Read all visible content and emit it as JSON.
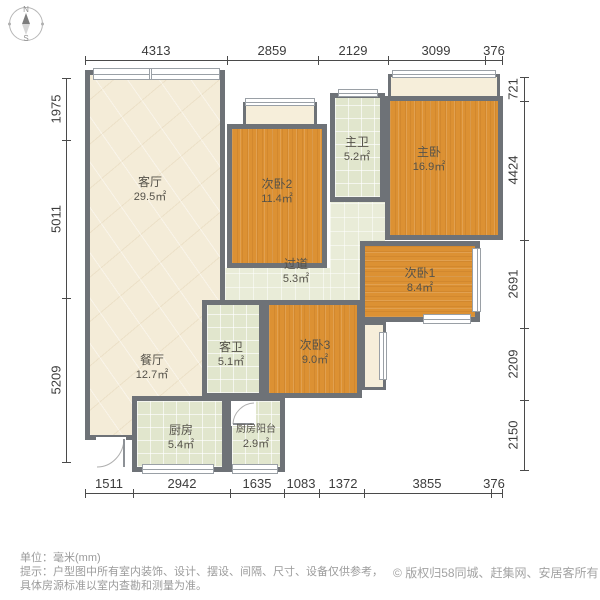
{
  "compass": {
    "north": "N",
    "south": "S"
  },
  "dimensions": {
    "unit_note": "mm",
    "top": [
      "4313",
      "2859",
      "2129",
      "3099",
      "376"
    ],
    "bottom": [
      "1511",
      "2942",
      "1635",
      "1083",
      "1372",
      "3855",
      "376"
    ],
    "left": [
      "1975",
      "5011",
      "5209"
    ],
    "right": [
      "721",
      "4424",
      "2691",
      "2209",
      "2150"
    ]
  },
  "rooms": [
    {
      "name": "living-room",
      "label": "客厅",
      "area": "29.5㎡"
    },
    {
      "name": "dining-room",
      "label": "餐厅",
      "area": "12.7㎡"
    },
    {
      "name": "bedroom-2",
      "label": "次卧2",
      "area": "11.4㎡"
    },
    {
      "name": "master-bath",
      "label": "主卫",
      "area": "5.2㎡"
    },
    {
      "name": "master-bedroom",
      "label": "主卧",
      "area": "16.9㎡"
    },
    {
      "name": "bedroom-1",
      "label": "次卧1",
      "area": "8.4㎡"
    },
    {
      "name": "corridor",
      "label": "过道",
      "area": "5.3㎡"
    },
    {
      "name": "guest-bath",
      "label": "客卫",
      "area": "5.1㎡"
    },
    {
      "name": "bedroom-3",
      "label": "次卧3",
      "area": "9.0㎡"
    },
    {
      "name": "kitchen",
      "label": "厨房",
      "area": "5.4㎡"
    },
    {
      "name": "kitchen-balcony",
      "label": "厨房阳台",
      "area": "2.9㎡"
    }
  ],
  "footer": {
    "unit_line": "单位：毫米(mm)",
    "tip_line1": "提示：户型图中所有室内装饰、设计、摆设、间隔、尺寸、设备仅供参考，",
    "tip_line2": "具体房源标准以室内查勘和测量为准。",
    "copyright_icon": "©",
    "copyright_text": "版权归58同城、赶集网、安居客所有"
  },
  "colors": {
    "wall": "#6e7277",
    "wood_floor": "#dc9133",
    "tile_floor": "#e1e6cd",
    "marble_floor": "#f4ecd8",
    "corridor_floor": "#e9ecd8",
    "dim_text": "#3c3c3c",
    "footer_text": "#9b9b9b"
  }
}
